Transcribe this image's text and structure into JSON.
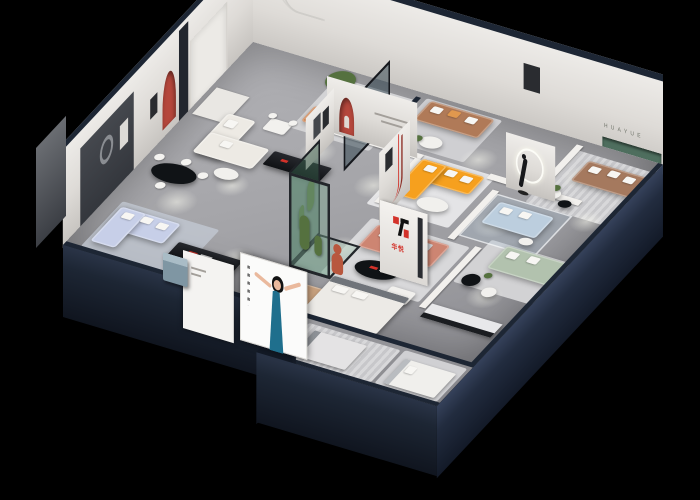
{
  "branding": {
    "logo_text": "华悦",
    "wall_letters": "HUAYUE"
  },
  "palette": {
    "background": "#000000",
    "wall_navy": "#1d2634",
    "wall_navy_light": "#2c3850",
    "back_wall": "#e6e3df",
    "floor_gray": "#a6a6aa",
    "accent_red_arch": "#b5473c",
    "logo_red": "#d3322a",
    "sofa_periwinkle": "#c7cfe8",
    "sofa_cream": "#edeae4",
    "sofa_teal": "#7e9aa6",
    "sofa_leather_brown": "#b07a58",
    "armchair_orange": "#c97b46",
    "sofa_orange": "#f6a01e",
    "sofa_salmon": "#cd8572",
    "sofa_sage": "#b2c2ae",
    "sofa_powder_blue": "#bccede",
    "sofa_fabric_brown": "#a5795e",
    "armchair_tan": "#c8a17e",
    "plant_green": "#55713f",
    "bear_terracotta": "#b8573e",
    "poster_dress_teal": "#1f6f8d",
    "green_shelf": "#4e6e5e"
  }
}
